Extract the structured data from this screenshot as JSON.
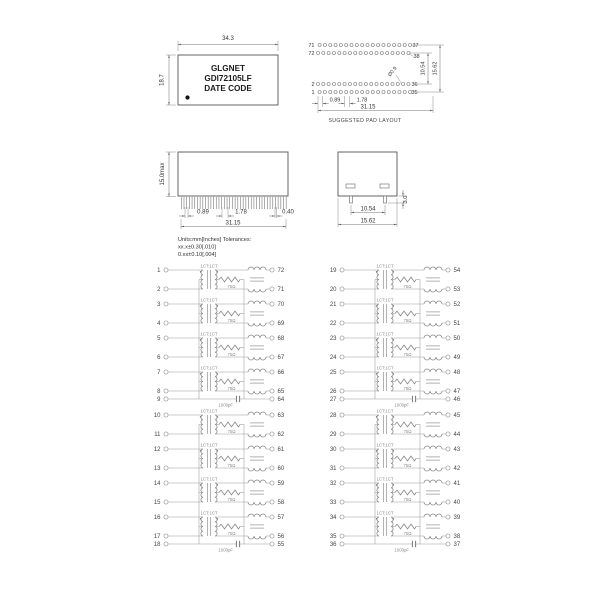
{
  "title_block": {
    "line1": "GLGNET",
    "line2": "GDI72105LF",
    "line3": "DATE CODE"
  },
  "package_outline": {
    "width_dim": "34.3",
    "height_dim": "18.7"
  },
  "pad_layout": {
    "caption": "SUGGESTED PAD LAYOUT",
    "hole_diameter": "Ø0.9",
    "pads_per_row": 18,
    "dim_offset": "0.89",
    "dim_pitch": "1.78",
    "dim_row_span": "31.15",
    "dim_rows_inner": "10.54",
    "dim_rows_outer": "15.62",
    "corner_pins": {
      "top_left_outer": "71",
      "top_left_inner": "72",
      "top_right_outer": "37",
      "top_right_inner": "38",
      "bottom_left_inner": "2",
      "bottom_left_outer": "1",
      "bottom_right_inner": "36",
      "bottom_right_outer": "35"
    }
  },
  "side_view": {
    "height_dim": "15.0max",
    "dim_offset": "0.89",
    "dim_pitch": "1.78",
    "dim_end": "0.40",
    "dim_span": "31.15"
  },
  "end_view": {
    "dim_inner": "10.54",
    "dim_outer": "15.62",
    "dim_standoff": "3.0"
  },
  "notes": {
    "line1": "Units:mm[Inches] Tolerances:",
    "line2": "xx.x±0.30[.010]",
    "line3": "0.xx±0.10[.004]"
  },
  "schematic": {
    "transformer_label": "1CT:1CT",
    "resistor_label": "75Ω",
    "capacitor_label": "1000pF",
    "blocks": [
      {
        "name": "left",
        "groups": [
          {
            "channels": [
              {
                "left": [
                  "1",
                  "2"
                ],
                "right": [
                  "72",
                  "71"
                ]
              },
              {
                "left": [
                  "3",
                  "4"
                ],
                "right": [
                  "70",
                  "69"
                ]
              },
              {
                "left": [
                  "5",
                  "6"
                ],
                "right": [
                  "68",
                  "67"
                ]
              },
              {
                "left": [
                  "7",
                  "8"
                ],
                "right": [
                  "66",
                  "65"
                ]
              }
            ],
            "cap_row": {
              "left": "9",
              "right": "64"
            }
          },
          {
            "channels": [
              {
                "left": [
                  "10",
                  "11"
                ],
                "right": [
                  "63",
                  "62"
                ]
              },
              {
                "left": [
                  "12",
                  "13"
                ],
                "right": [
                  "61",
                  "60"
                ]
              },
              {
                "left": [
                  "14",
                  "15"
                ],
                "right": [
                  "59",
                  "58"
                ]
              },
              {
                "left": [
                  "16",
                  "17"
                ],
                "right": [
                  "57",
                  "56"
                ]
              }
            ],
            "cap_row": {
              "left": "18",
              "right": "55"
            }
          }
        ]
      },
      {
        "name": "right",
        "groups": [
          {
            "channels": [
              {
                "left": [
                  "19",
                  "20"
                ],
                "right": [
                  "54",
                  "53"
                ]
              },
              {
                "left": [
                  "21",
                  "22"
                ],
                "right": [
                  "52",
                  "51"
                ]
              },
              {
                "left": [
                  "23",
                  "24"
                ],
                "right": [
                  "50",
                  "49"
                ]
              },
              {
                "left": [
                  "25",
                  "26"
                ],
                "right": [
                  "48",
                  "47"
                ]
              }
            ],
            "cap_row": {
              "left": "27",
              "right": "46"
            }
          },
          {
            "channels": [
              {
                "left": [
                  "28",
                  "29"
                ],
                "right": [
                  "45",
                  "44"
                ]
              },
              {
                "left": [
                  "30",
                  "31"
                ],
                "right": [
                  "43",
                  "42"
                ]
              },
              {
                "left": [
                  "32",
                  "33"
                ],
                "right": [
                  "41",
                  "40"
                ]
              },
              {
                "left": [
                  "34",
                  "35"
                ],
                "right": [
                  "39",
                  "38"
                ]
              }
            ],
            "cap_row": {
              "left": "36",
              "right": "37"
            }
          }
        ]
      }
    ]
  }
}
